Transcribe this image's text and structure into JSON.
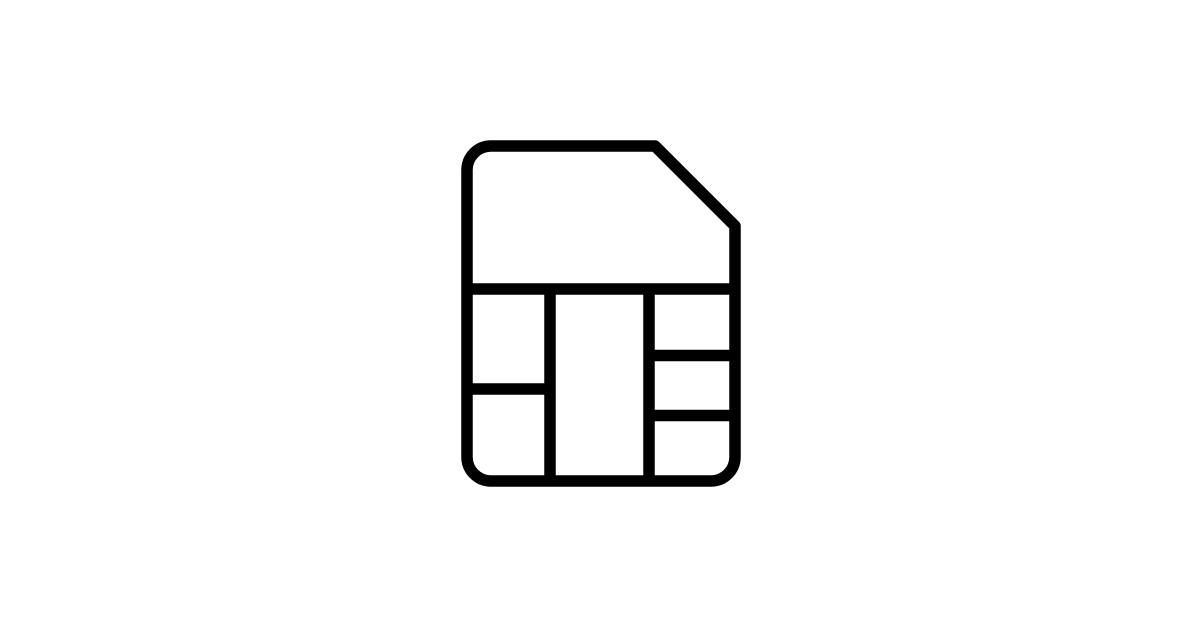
{
  "canvas": {
    "width": 1200,
    "height": 628,
    "background": "#ffffff"
  },
  "icon": {
    "name": "sim-card-icon",
    "description": "Outline pictogram of a SIM card with a clipped top-right corner and a six-segment chip contact grid",
    "color": "#000000",
    "stroke_width": 11.5
  }
}
